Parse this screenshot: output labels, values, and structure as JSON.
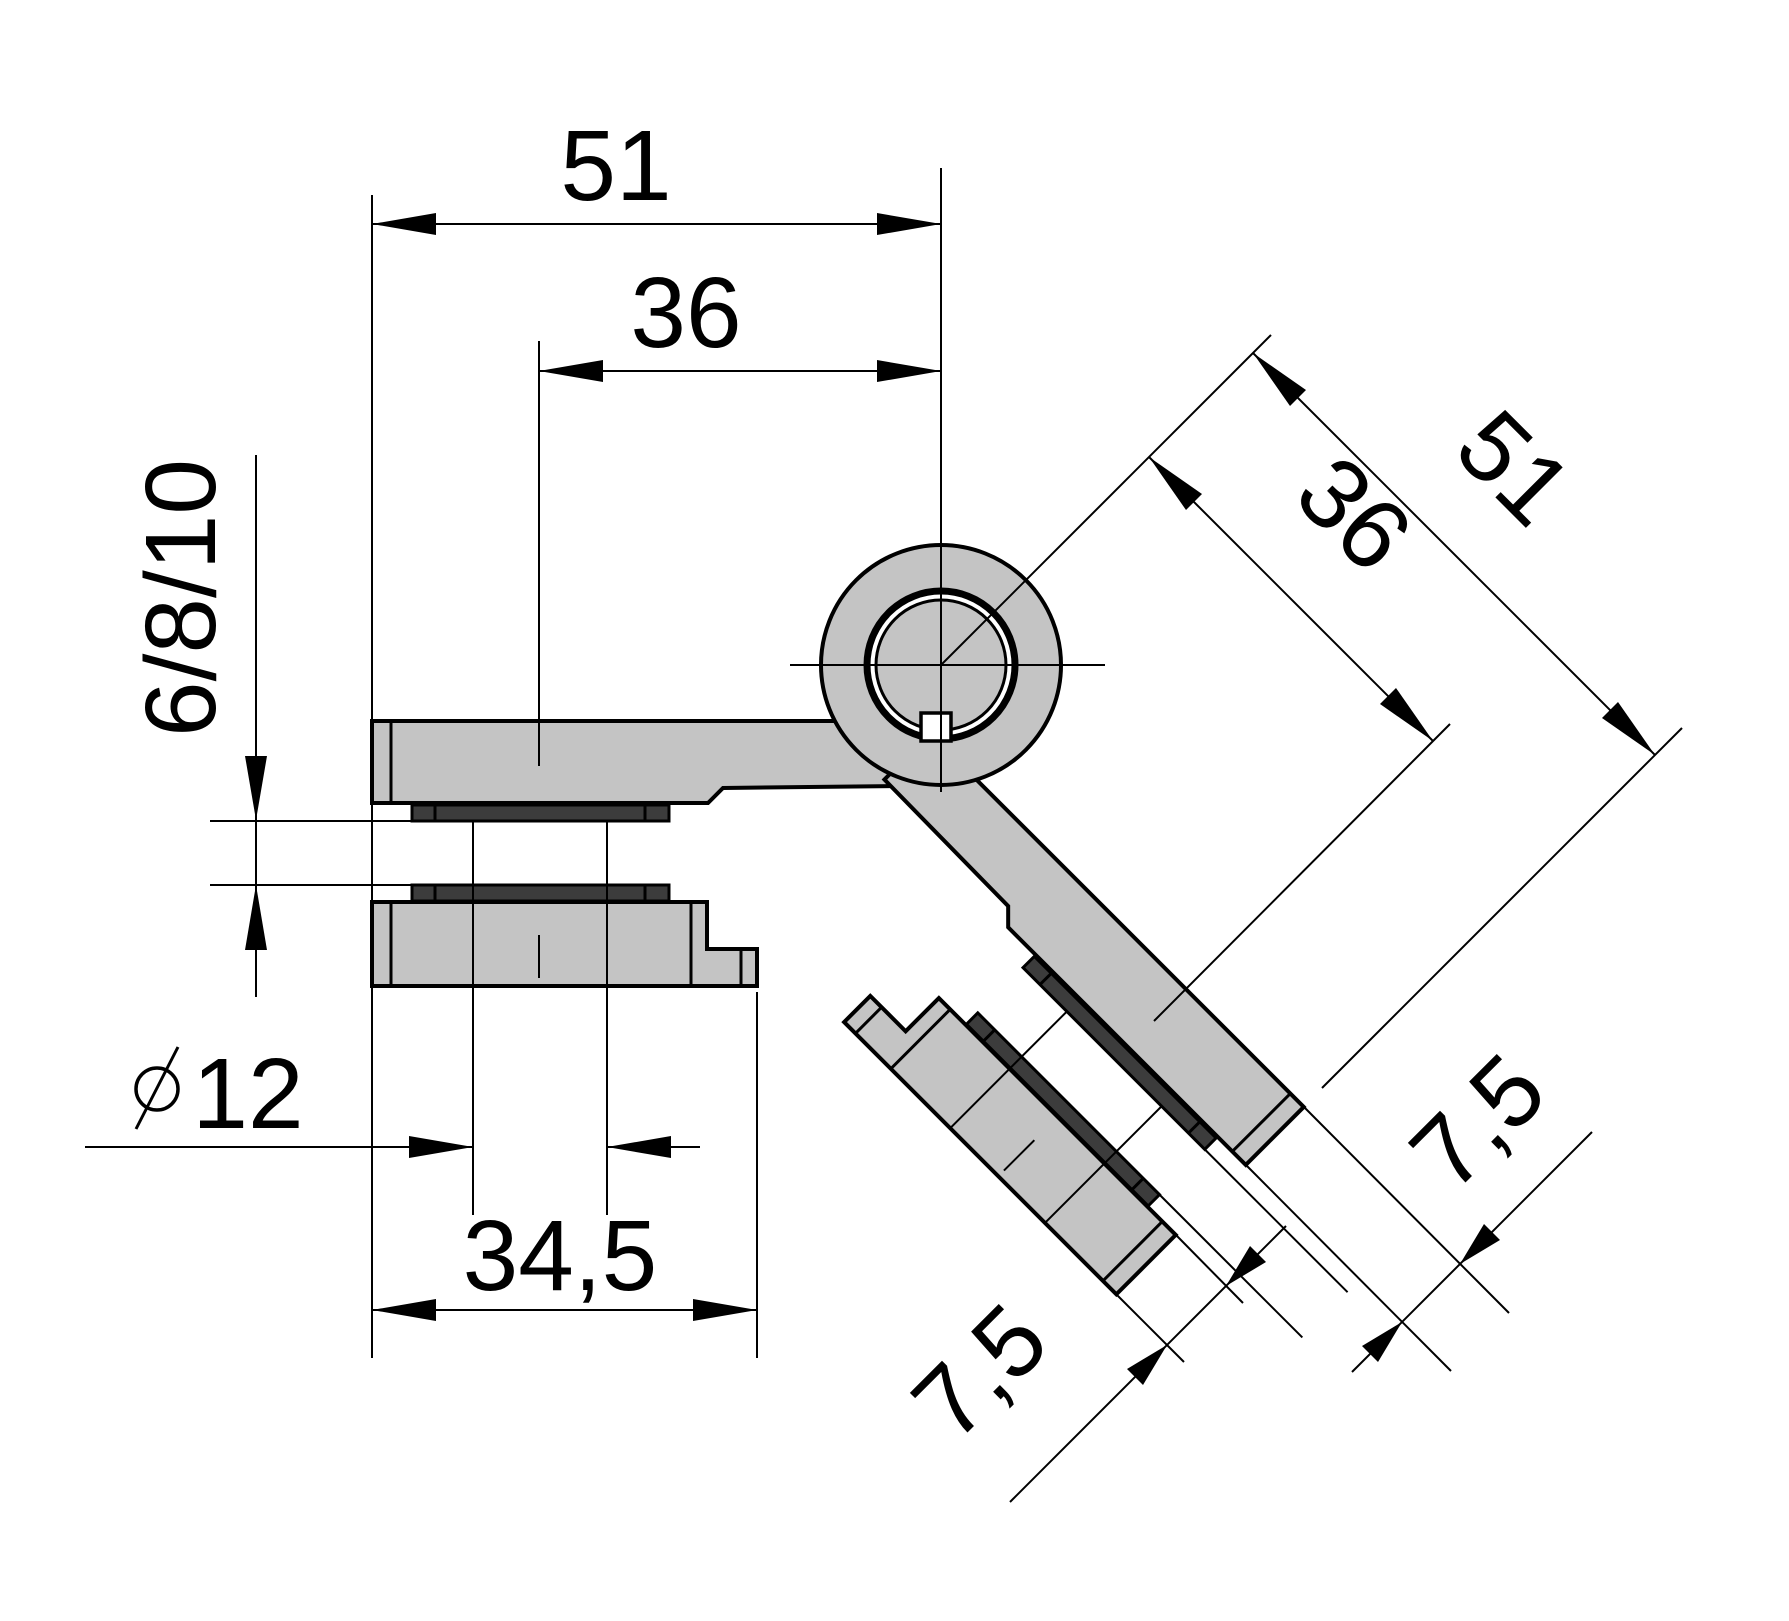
{
  "dimensions": {
    "top_width": "51",
    "top_inner_width": "36",
    "glass_thickness": "6/8/10",
    "diameter_symbol": "⌀",
    "hole_diameter": "12",
    "clamp_width": "34,5",
    "diag_width": "51",
    "diag_inner_width": "36",
    "clamp_plate_thickness": "7,5",
    "arm_plate_thickness": "7,5"
  },
  "colors": {
    "body": "#c4c4c4",
    "gasket": "#3c3c3c",
    "line": "#000000",
    "background": "#ffffff"
  }
}
